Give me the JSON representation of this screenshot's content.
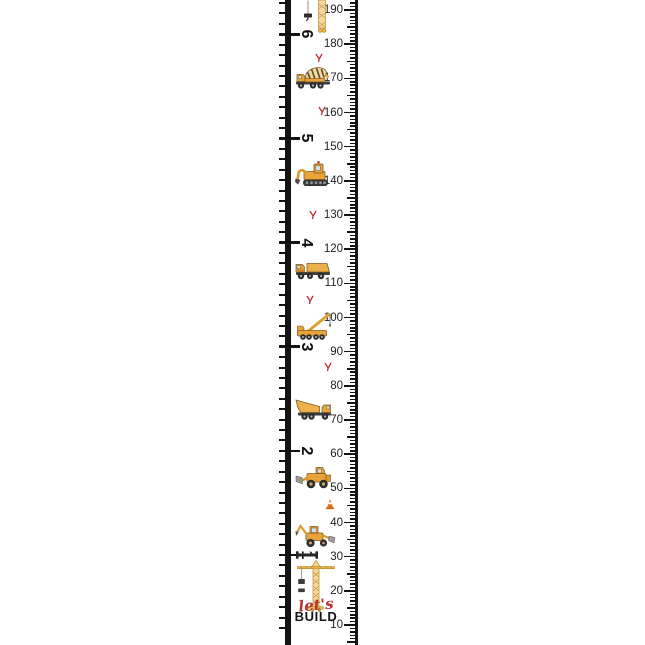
{
  "ruler": {
    "px_per_cm": 3.4167,
    "cm_top_label": 190,
    "y_of_top_label": 10,
    "cm_labels": [
      190,
      180,
      170,
      160,
      150,
      140,
      130,
      120,
      110,
      100,
      90,
      80,
      70,
      60,
      50,
      40,
      30,
      20,
      10
    ],
    "feet_labels": [
      "6",
      "5",
      "4",
      "3",
      "2",
      "1"
    ]
  },
  "decorations": {
    "vehicles": [
      {
        "name": "hanging-hook",
        "y": 11.5,
        "cx": 308
      },
      {
        "name": "crane-mast-top",
        "y": 17,
        "cx": 322
      },
      {
        "name": "cement-mixer-truck",
        "cm": 170.5,
        "cx": 314
      },
      {
        "name": "excavator",
        "cm": 142.5,
        "cx": 313
      },
      {
        "name": "dump-truck",
        "cm": 114.5,
        "cx": 313
      },
      {
        "name": "mobile-crane",
        "cm": 98,
        "cx": 316
      },
      {
        "name": "tipper-truck",
        "cm": 73.5,
        "cx": 314
      },
      {
        "name": "wheel-loader",
        "cm": 53.5,
        "cx": 315
      },
      {
        "name": "traffic-cone",
        "cm": 45.5,
        "cx": 330
      },
      {
        "name": "backhoe-loader",
        "cm": 36.5,
        "cx": 315
      },
      {
        "name": "spirit-level",
        "cm": 30.5,
        "cx": 307
      },
      {
        "name": "tower-crane",
        "cm": 21.5,
        "cx": 316
      }
    ],
    "footprints": [
      {
        "cm": 176,
        "x": 319
      },
      {
        "cm": 160.5,
        "x": 322
      },
      {
        "cm": 130,
        "x": 313
      },
      {
        "cm": 105,
        "x": 310
      },
      {
        "cm": 85.5,
        "x": 328
      }
    ]
  },
  "footer": {
    "script_text": "let's",
    "caps_text": "BUILD"
  },
  "colors": {
    "vehicle_yellow": "#E8A33D",
    "vehicle_tan": "#F3D9A0",
    "detail_dark": "#3b3b3b",
    "accent_red": "#C0272D",
    "tick_black": "#141414",
    "label_color": "#222222"
  }
}
